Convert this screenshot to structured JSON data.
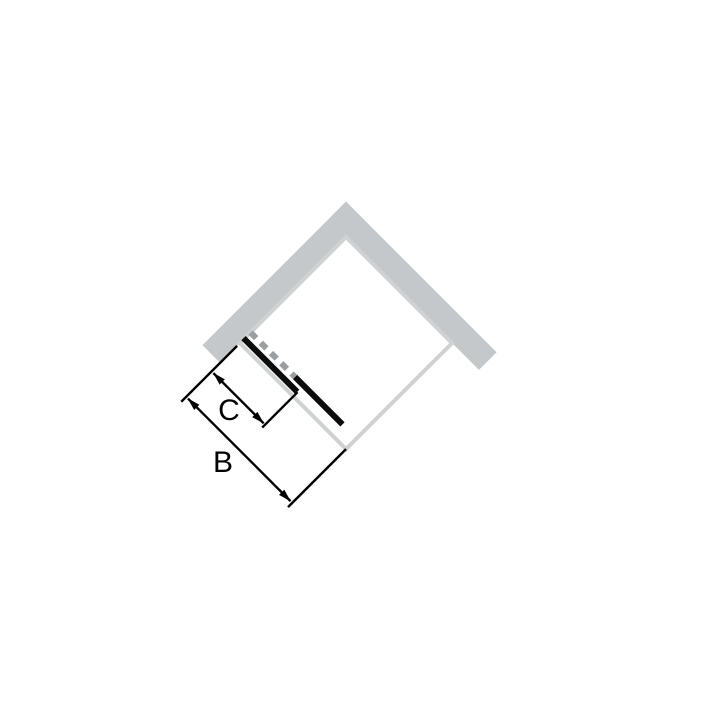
{
  "diagram": {
    "kind": "corner shower enclosure with sliding door, top view rotated 45 degrees",
    "labels": {
      "total_width": "B",
      "panel_width": "C"
    },
    "colors": {
      "background": "#ffffff",
      "wall": "#c5c8ca",
      "tray_edge": "#cfd1d2",
      "door_open_dashed": "#9b9ea0",
      "door_panel": "#0b0b0b",
      "dimension": "#000000",
      "label_text": "#000000"
    }
  }
}
